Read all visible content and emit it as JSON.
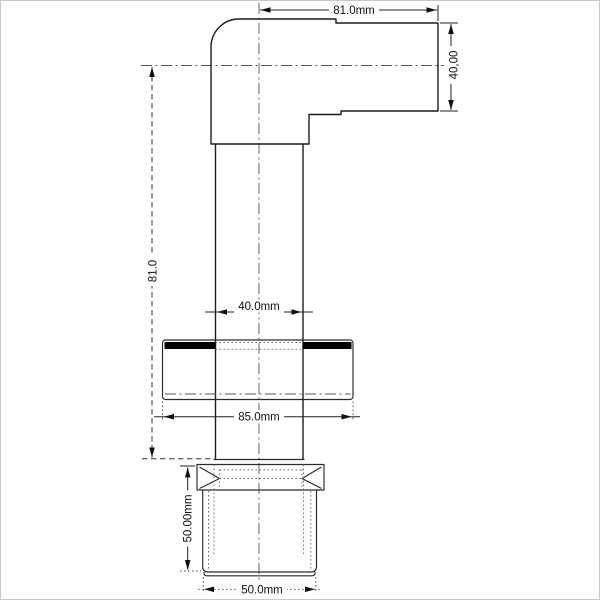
{
  "page": {
    "background": "#ffffff",
    "border_color": "#c9c9c9"
  },
  "drawing": {
    "line_color": "#1c1c1c",
    "centerline_color": "#555555",
    "hidden_line_color": "#666666",
    "seal_color": "#000000",
    "labels": {
      "top_width": "81.0mm",
      "outlet_diameter": "40,00",
      "body_height": "81.0",
      "pipe_diameter": "40.0mm",
      "flange_width": "85.0mm",
      "socket_height": "50.00mm",
      "socket_diameter": "50.0mm"
    }
  }
}
